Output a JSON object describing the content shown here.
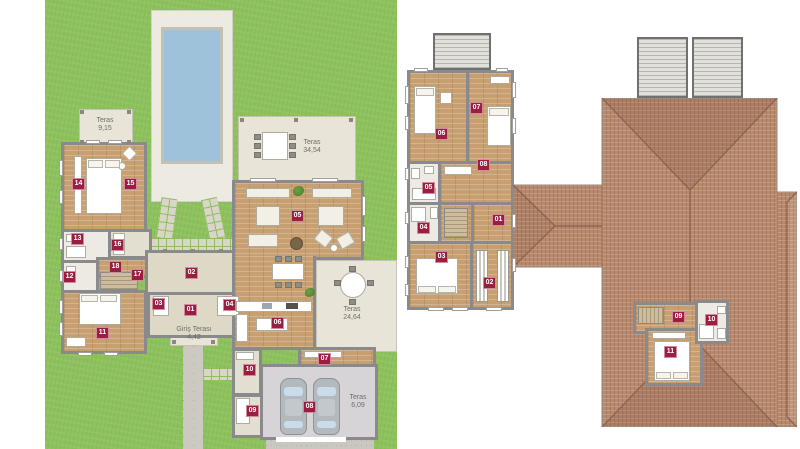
{
  "colors": {
    "badge": "#9b1e41",
    "grass": "#8dc15e",
    "wall": "#8a8a8c",
    "wood": "#c79f70",
    "roof": "#b8896d",
    "water": "#9ec2da"
  },
  "plans": {
    "ground_floor": {
      "badges": [
        {
          "n": "01",
          "x": 184,
          "y": 304
        },
        {
          "n": "02",
          "x": 185,
          "y": 267
        },
        {
          "n": "03",
          "x": 152,
          "y": 298
        },
        {
          "n": "04",
          "x": 223,
          "y": 299
        },
        {
          "n": "05",
          "x": 291,
          "y": 210
        },
        {
          "n": "06",
          "x": 271,
          "y": 317
        },
        {
          "n": "07",
          "x": 318,
          "y": 353
        },
        {
          "n": "08",
          "x": 303,
          "y": 401
        },
        {
          "n": "09",
          "x": 246,
          "y": 405
        },
        {
          "n": "10",
          "x": 243,
          "y": 364
        },
        {
          "n": "11",
          "x": 96,
          "y": 327
        },
        {
          "n": "12",
          "x": 63,
          "y": 271
        },
        {
          "n": "13",
          "x": 71,
          "y": 233
        },
        {
          "n": "14",
          "x": 72,
          "y": 178
        },
        {
          "n": "15",
          "x": 124,
          "y": 178
        },
        {
          "n": "16",
          "x": 111,
          "y": 239
        },
        {
          "n": "17",
          "x": 131,
          "y": 269
        },
        {
          "n": "18",
          "x": 109,
          "y": 261
        }
      ],
      "terrace_labels": [
        {
          "name": "Teras",
          "area": "9,15",
          "x": 80,
          "y": 117
        },
        {
          "name": "Teras",
          "area": "34,54",
          "x": 287,
          "y": 139
        },
        {
          "name": "Giriş Terası",
          "area": "4,42",
          "x": 169,
          "y": 326
        },
        {
          "name": "Teras",
          "area": "24,64",
          "x": 327,
          "y": 306
        },
        {
          "name": "Teras",
          "area": "6,09",
          "x": 333,
          "y": 394
        }
      ]
    },
    "upper_floor": {
      "badges": [
        {
          "n": "01",
          "x": 492,
          "y": 214
        },
        {
          "n": "02",
          "x": 483,
          "y": 277
        },
        {
          "n": "03",
          "x": 435,
          "y": 251
        },
        {
          "n": "04",
          "x": 417,
          "y": 222
        },
        {
          "n": "05",
          "x": 422,
          "y": 182
        },
        {
          "n": "06",
          "x": 435,
          "y": 128
        },
        {
          "n": "07",
          "x": 470,
          "y": 102
        },
        {
          "n": "08",
          "x": 477,
          "y": 159
        }
      ]
    },
    "attic": {
      "badges": [
        {
          "n": "09",
          "x": 672,
          "y": 311
        },
        {
          "n": "10",
          "x": 705,
          "y": 314
        },
        {
          "n": "11",
          "x": 664,
          "y": 346
        }
      ]
    }
  }
}
